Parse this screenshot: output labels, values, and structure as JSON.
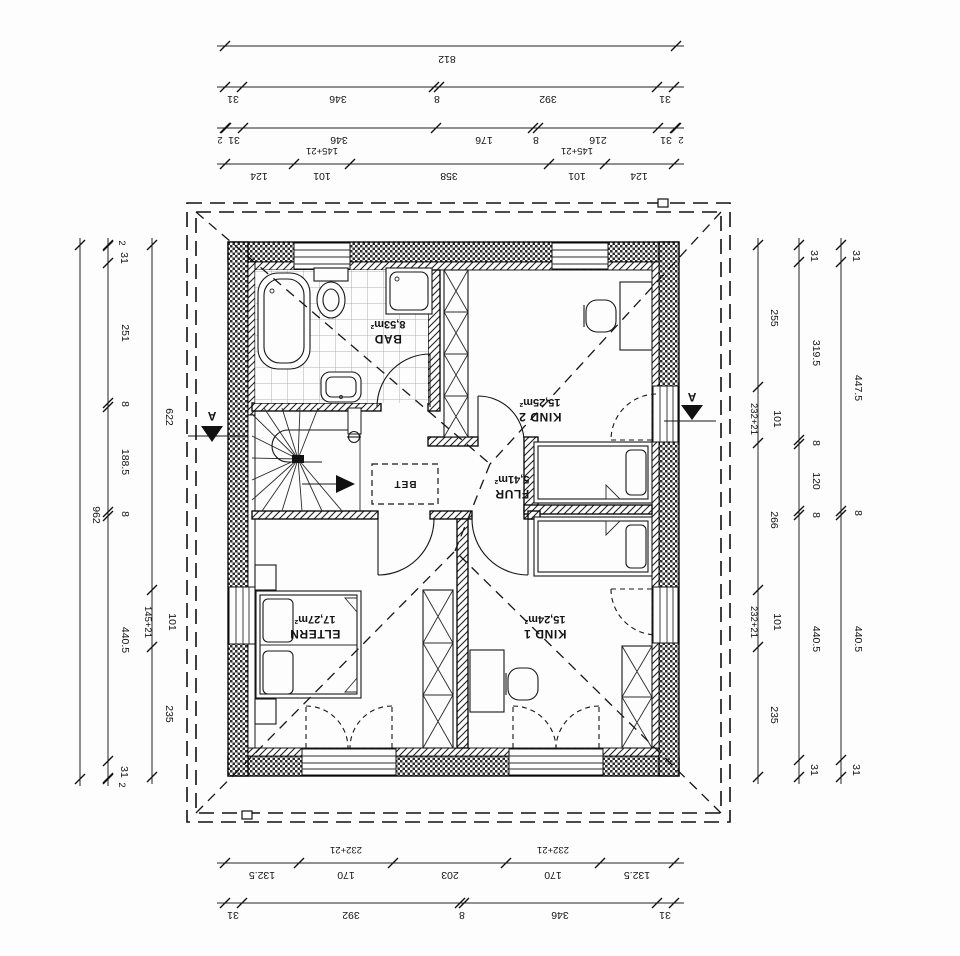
{
  "rooms": {
    "bad": {
      "name": "BAD",
      "area": "8,53m²"
    },
    "kind2": {
      "name": "KIND 2",
      "area": "15,25m²"
    },
    "flur": {
      "name": "FLUR",
      "area": "5,41m²"
    },
    "eltern": {
      "name": "ELTERN",
      "area": "17,27m²"
    },
    "kind1": {
      "name": "KIND 1",
      "area": "15,24m²"
    }
  },
  "annotations": {
    "bet_box": "BET",
    "section_letter": "A"
  },
  "dims": {
    "top": {
      "total": "812",
      "row2": [
        "31",
        "346",
        "8",
        "392",
        "31"
      ],
      "row3": [
        "2",
        "31",
        "346",
        "176",
        "8",
        "216",
        "31",
        "2"
      ],
      "row4": [
        "124",
        "101",
        "358",
        "101",
        "124"
      ],
      "row4_note": "145+21"
    },
    "bottom": {
      "row1": [
        "132.5",
        "170",
        "203",
        "170",
        "132.5"
      ],
      "row1_note": "232+21",
      "row2": [
        "31",
        "392",
        "8",
        "346",
        "31"
      ]
    },
    "left": {
      "total": "962",
      "mid": [
        "2",
        "31",
        "251",
        "8",
        "188.5",
        "8",
        "440.5",
        "31",
        "2"
      ],
      "inner": [
        "622",
        "101",
        "235"
      ],
      "inner_note": "145+21"
    },
    "right": {
      "inner": [
        "255",
        "101",
        "266",
        "101",
        "235"
      ],
      "inner_note": "232+21",
      "mid": [
        "31",
        "319.5",
        "8",
        "120",
        "8",
        "440.5",
        "31"
      ],
      "outer": [
        "31",
        "447.5",
        "8",
        "440.5",
        "31"
      ]
    }
  }
}
